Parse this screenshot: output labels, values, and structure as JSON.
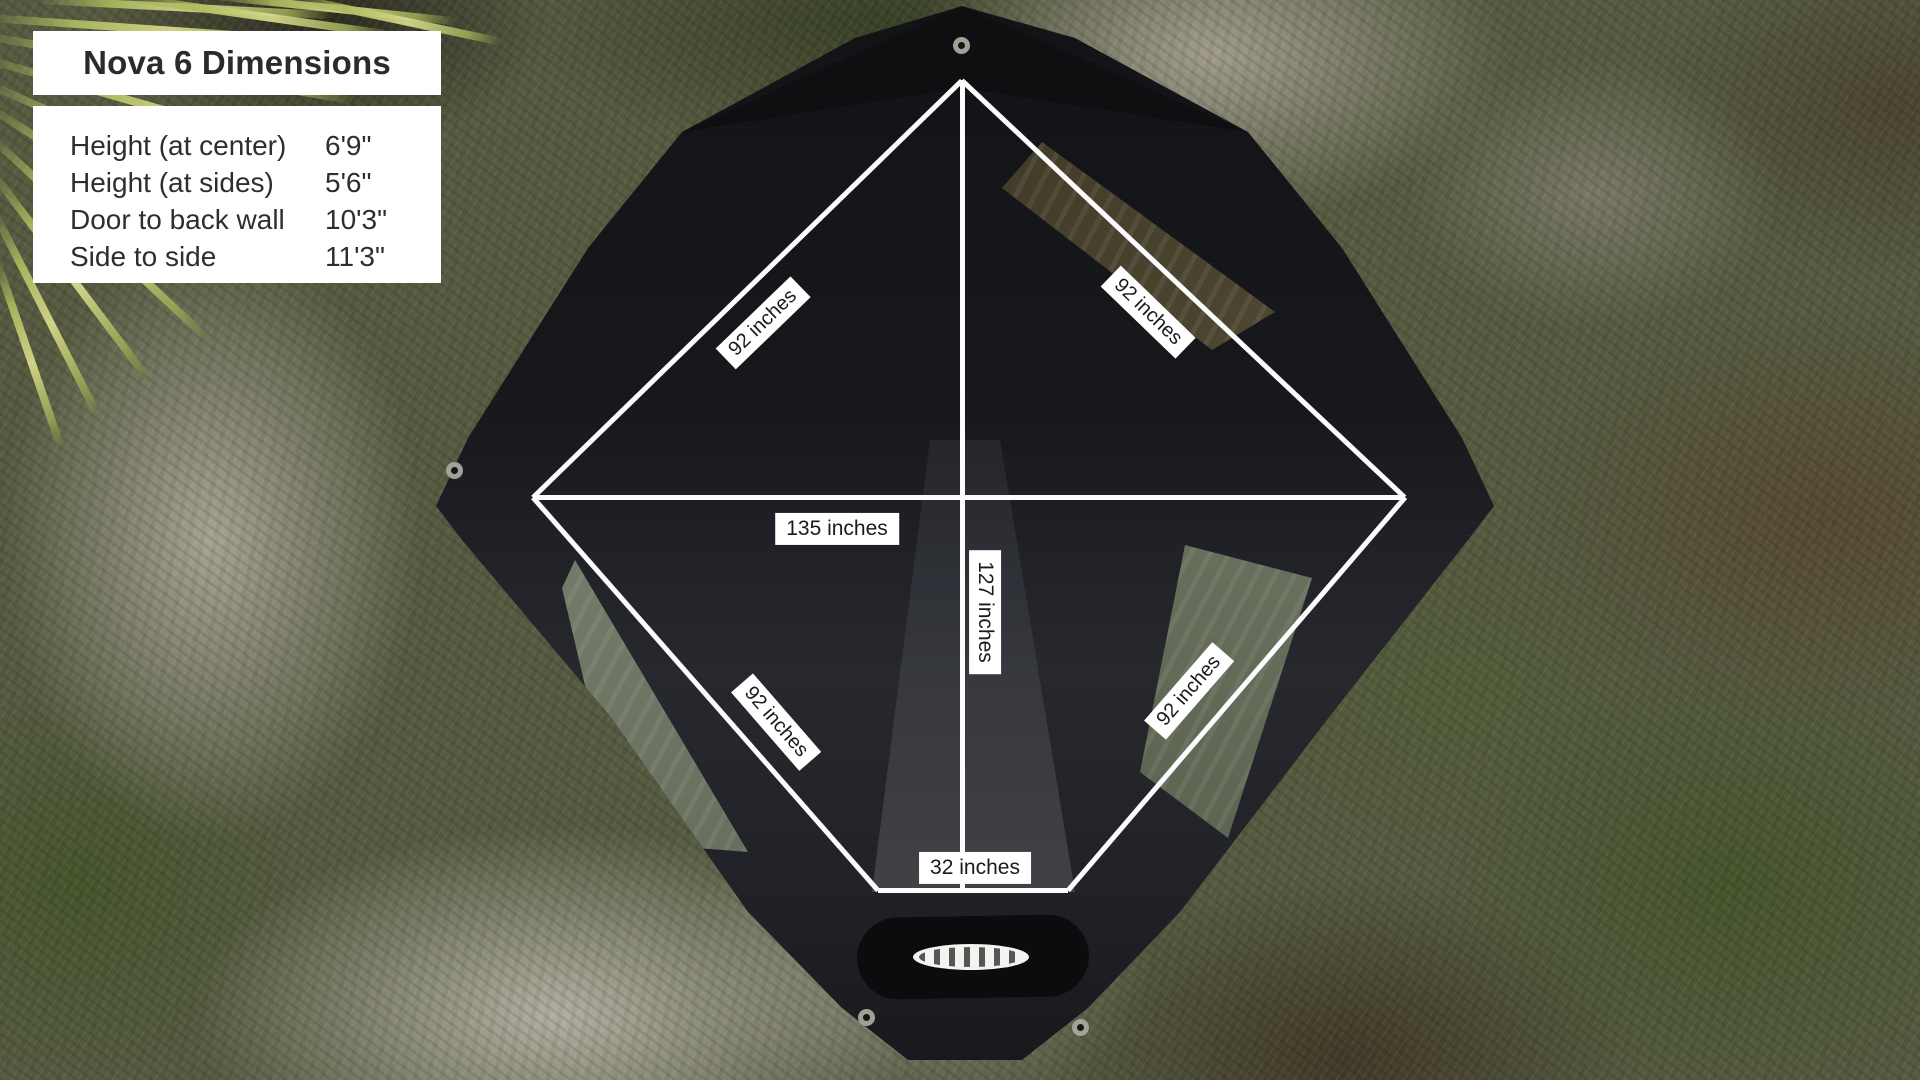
{
  "info_panel": {
    "title": "Nova 6 Dimensions",
    "rows": [
      {
        "label": "Height (at center)",
        "value": "6'9\""
      },
      {
        "label": "Height (at sides)",
        "value": "5'6\""
      },
      {
        "label": "Door to back wall",
        "value": "10'3\""
      },
      {
        "label": "Side to side",
        "value": "11'3\""
      }
    ]
  },
  "measurements": {
    "diagonal_labels": [
      "92 inches",
      "92 inches",
      "92 inches",
      "92 inches"
    ],
    "side_to_side": "135 inches",
    "door_to_back": "127 inches",
    "door_width": "32 inches"
  },
  "colors": {
    "panel_bg": "#ffffff",
    "panel_text": "#2b2b2b",
    "measure_line": "#fcfcfc",
    "tent_fabric": "#1a1b1e"
  }
}
